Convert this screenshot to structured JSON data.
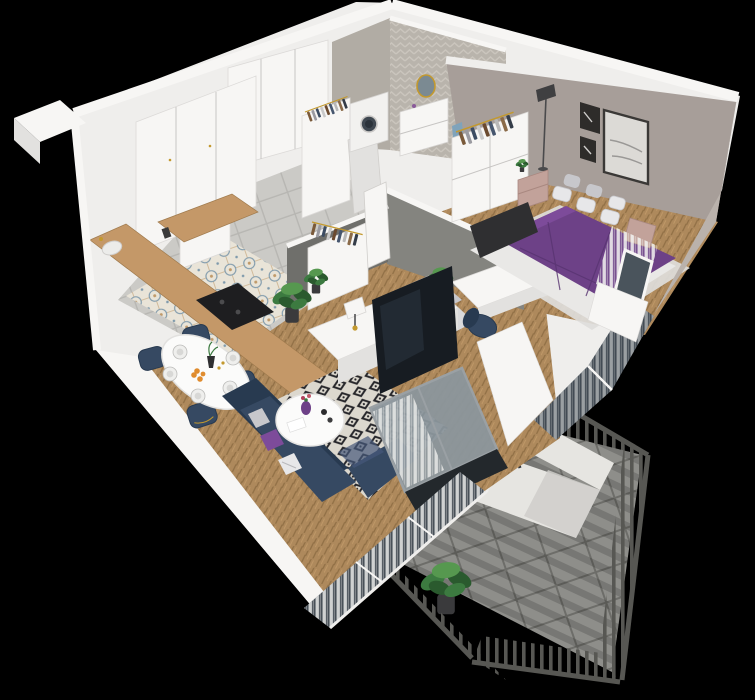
{
  "meta": {
    "title": "3d-apartment-floorplan-render",
    "view": "isometric-cutaway",
    "background": "black"
  },
  "palette": {
    "bg": "#000000",
    "wall": "#efeeec",
    "wallBright": "#f7f6f4",
    "wallShade": "#e2e1df",
    "wallDark": "#d3d1cf",
    "wallEdge": "#c7c5c3",
    "tileGrey": "#cbcac6",
    "tileGrout": "#b7b6b2",
    "decoCream": "#e9e4d8",
    "decoBlue": "#7e99ab",
    "decoTan": "#c09a6a",
    "woodLight": "#ae895c",
    "woodDark": "#917046",
    "woodLine": "#c8a06e",
    "counterWood": "#c49868",
    "cooktop": "#1e1e20",
    "rugCream": "#dcd8ce",
    "rugBlack": "#26262a",
    "taupeWall": "#a79e99",
    "taupeLight": "#bab2ac",
    "greyWall": "#84847f",
    "greyWallDark": "#6f6f6b",
    "bathWallA": "#b9b4ac",
    "bathWallB": "#cac5bd",
    "navy": "#364962",
    "navyDark": "#283a50",
    "navyLight": "#46597a",
    "purple": "#6d4187",
    "purpleDark": "#583370",
    "purpleLight": "#7d4b9a",
    "pillowWhite": "#e7e7e9",
    "pillowGrey": "#c7c7cb",
    "pink": "#c2a29a",
    "pinkDark": "#a98880",
    "glass": "#8b969c",
    "glassDark": "#39424b",
    "curtain": "#f3f3f1",
    "frameDark": "#30343a",
    "rail": "#575753",
    "railDark": "#454541",
    "balconyFloor": "#8e8e8a",
    "balconyGrout": "#6d6d69",
    "bench": "#e6e5e1",
    "benchShade": "#cfcecA",
    "plantGreen": "#3c7a40",
    "plantDark": "#2a5a2e",
    "plantLight": "#56984f",
    "gold": "#c3992e",
    "orange": "#e08c2e",
    "tv": "#171c22",
    "tvSheen": "#2c3642",
    "mirror": "#7b8a92",
    "washerDoor": "#3f4750",
    "artDark": "#2e2c2a",
    "artLight": "#dcdad6",
    "doorWhite": "#f6f5f3",
    "white": "#fbfbfa"
  },
  "scene": {
    "rooms": [
      {
        "name": "kitchen",
        "floor": "patterned-cement-tile",
        "items": [
          "tall-white-cabinets",
          "l-shaped-wood-countertop",
          "sink-gold-faucet",
          "black-cooktop"
        ]
      },
      {
        "name": "hallway",
        "floor": "grey-tile",
        "items": [
          "entrance-door",
          "white-wardrobe",
          "open-closet-with-clothes",
          "dresser-with-clothes-rail"
        ]
      },
      {
        "name": "bathroom",
        "walls": "herringbone-tile",
        "items": [
          "washing-machine",
          "white-vanity",
          "round-gold-mirror",
          "blue-towel"
        ]
      },
      {
        "name": "bedroom",
        "floor": "herringbone-wood",
        "items": [
          "double-bed-purple-duvet",
          "white-pillows",
          "dark-footboard",
          "pink-nightstands",
          "open-wardrobe-with-clothes",
          "floor-lamp",
          "art-frames",
          "white-curtains"
        ]
      },
      {
        "name": "office-nook",
        "items": [
          "white-desk",
          "navy-desk-chair",
          "daybed-with-cushions",
          "potted-plant",
          "grey-divider-wall"
        ]
      },
      {
        "name": "living-dining-room",
        "floor": "herringbone-wood",
        "items": [
          "oval-dining-table-set",
          "navy-dining-chairs",
          "navy-corner-sofa",
          "throw-pillows",
          "round-coffee-table",
          "black-white-diamond-rug",
          "tv-on-white-console",
          "table-lamp",
          "potted-plants",
          "sliding-glass-door"
        ]
      },
      {
        "name": "balcony",
        "floor": "grey-tile",
        "items": [
          "dark-metal-railing",
          "outdoor-seat-orange-strap",
          "large-potted-plant"
        ]
      }
    ]
  }
}
